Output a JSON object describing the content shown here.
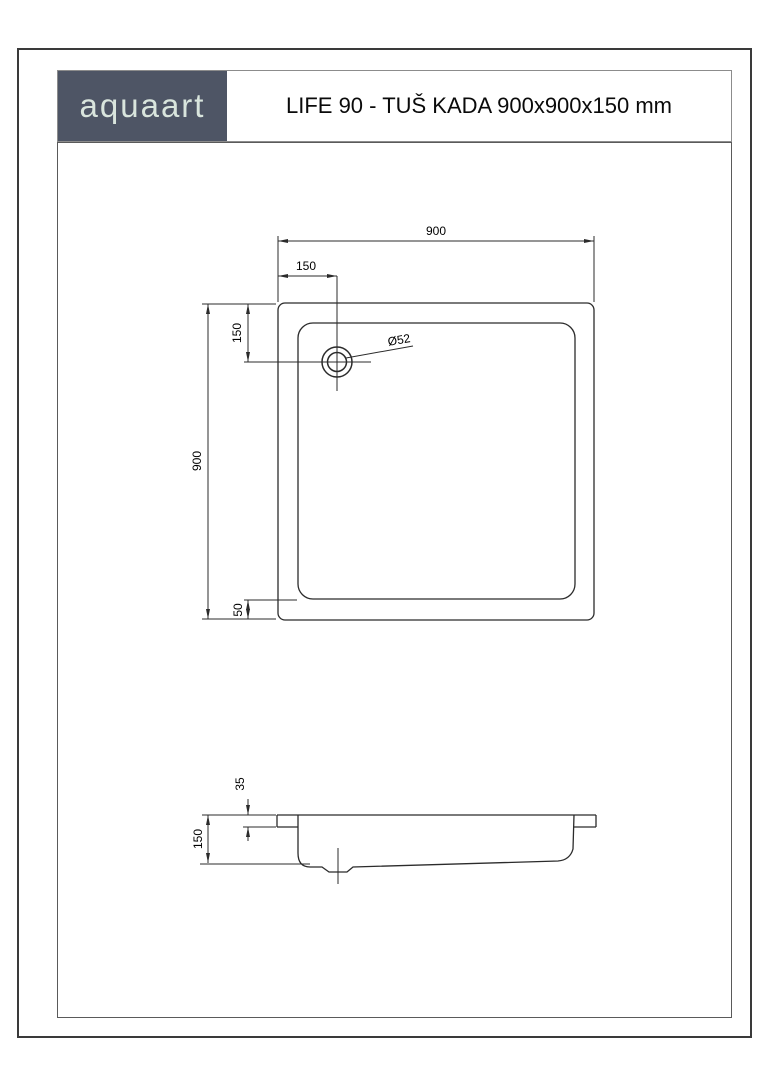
{
  "header": {
    "logo_text": "aquaart",
    "title": "LIFE 90 - TUŠ KADA 900x900x150 mm"
  },
  "colors": {
    "logo_background": "#4e5565",
    "logo_foreground": "#d9e5dd",
    "drawing_line": "#2b2b2b",
    "sheet_border": "#3a3a3a"
  },
  "top_view": {
    "overall_width_label": "900",
    "overall_depth_label": "900",
    "drain_offset_from_left_label": "150",
    "drain_offset_from_top_label": "150",
    "bottom_inner_edge_offset_label": "50",
    "drain_diameter_label": "Ø52"
  },
  "side_view": {
    "total_height_label": "150",
    "rim_height_label": "35"
  }
}
